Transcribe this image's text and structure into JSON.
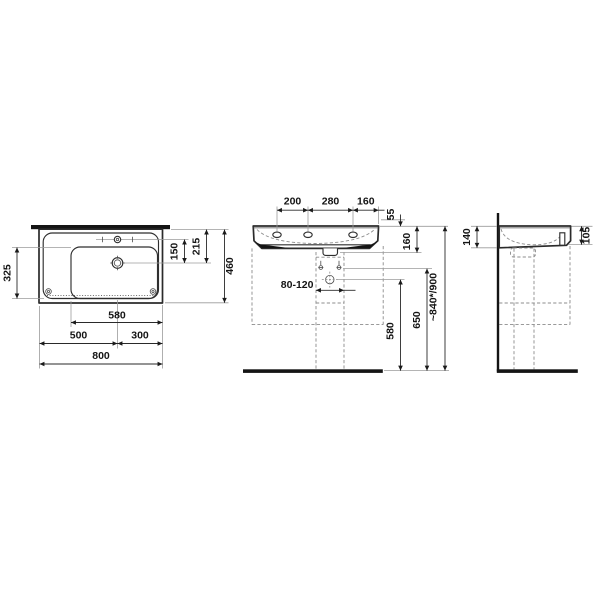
{
  "drawing": {
    "type": "washbasin-installation-dimension-drawing",
    "colors": {
      "background": "#ffffff",
      "main_line": "#2b2b2b",
      "dimension_text": "#141414",
      "extension_line": "#9b9b9b",
      "dashed_line": "#8c8c8c",
      "solid_fill": "#141414"
    },
    "plan_view": {
      "total_width": "800",
      "left_split": "500",
      "right_split": "300",
      "bowl_width": "580",
      "bowl_depth": "325",
      "tap_to_drain": "150",
      "edge_to_drain": "215",
      "total_depth": "460"
    },
    "front_view": {
      "taphole_span_left": "200",
      "taphole_span_mid": "280",
      "taphole_span_right": "160",
      "rim_offset": "55",
      "body_height": "160",
      "pipe_range": "80-120",
      "drain_height": "580",
      "fixing_height": "650",
      "install_height": "~840*/900"
    },
    "side_view": {
      "back_height": "140",
      "front_height": "105"
    }
  }
}
